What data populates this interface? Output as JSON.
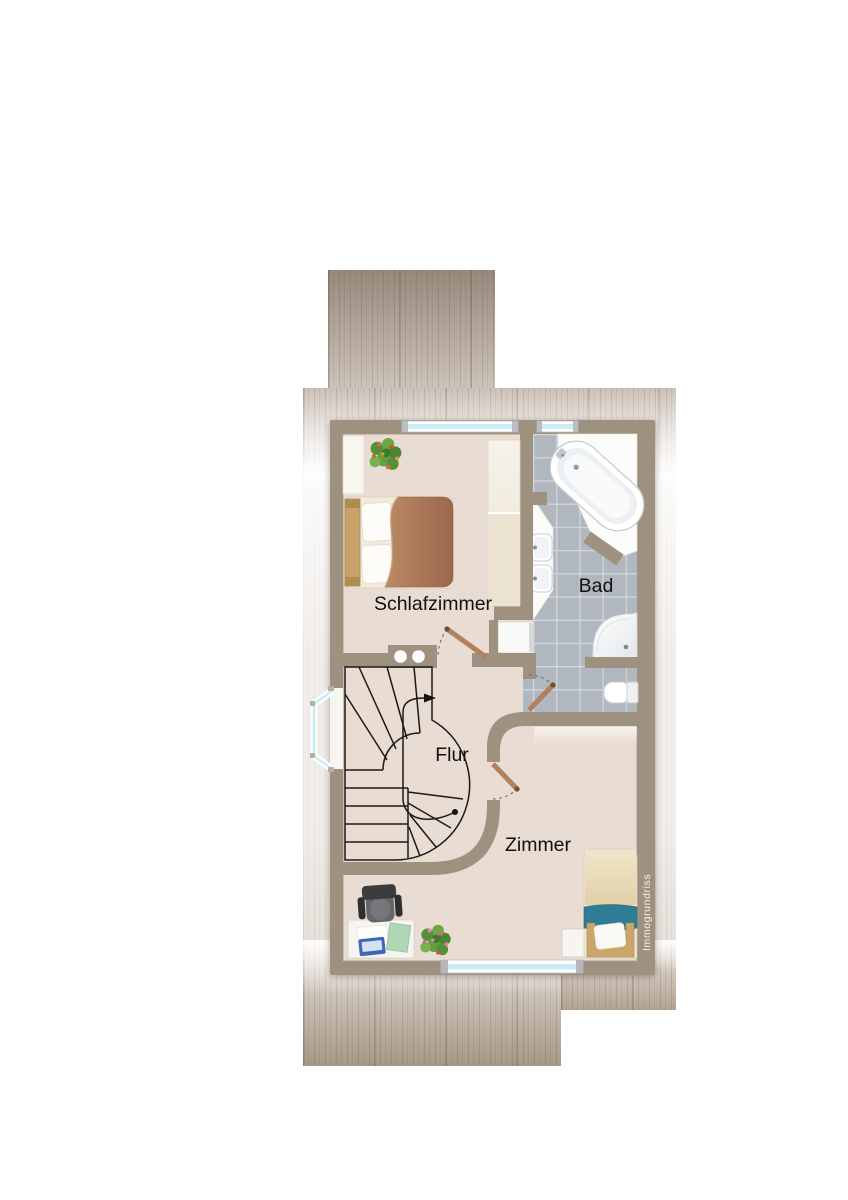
{
  "watermark": "Immogrundriss",
  "rooms": {
    "schlafzimmer": "Schlafzimmer",
    "bad": "Bad",
    "flur": "Flur",
    "zimmer": "Zimmer"
  },
  "fixtures": {
    "schlafzimmer": [
      "double-bed",
      "wardrobe",
      "closet",
      "potted-plant",
      "window"
    ],
    "bad": [
      "bathtub",
      "washbasin",
      "washbasin",
      "washing-machine",
      "shower",
      "toilet",
      "window"
    ],
    "flur": [
      "staircase",
      "bay-window"
    ],
    "zimmer": [
      "single-bed",
      "nightstand",
      "desk",
      "office-chair",
      "potted-plant",
      "window"
    ]
  },
  "colors": {
    "wall": "#9f9180",
    "floor": "#e9dcd2",
    "tile": "#b1b7bf",
    "grout": "#d3d8dc",
    "glass": "#c9ecf5",
    "door": "#b0815a",
    "stairline": "#1a1a1a",
    "label": "#101010",
    "teal": "#2e7d95",
    "bedframe": "#c9a66a",
    "blanket": "#a97a58",
    "watermark": "#ffffff"
  }
}
